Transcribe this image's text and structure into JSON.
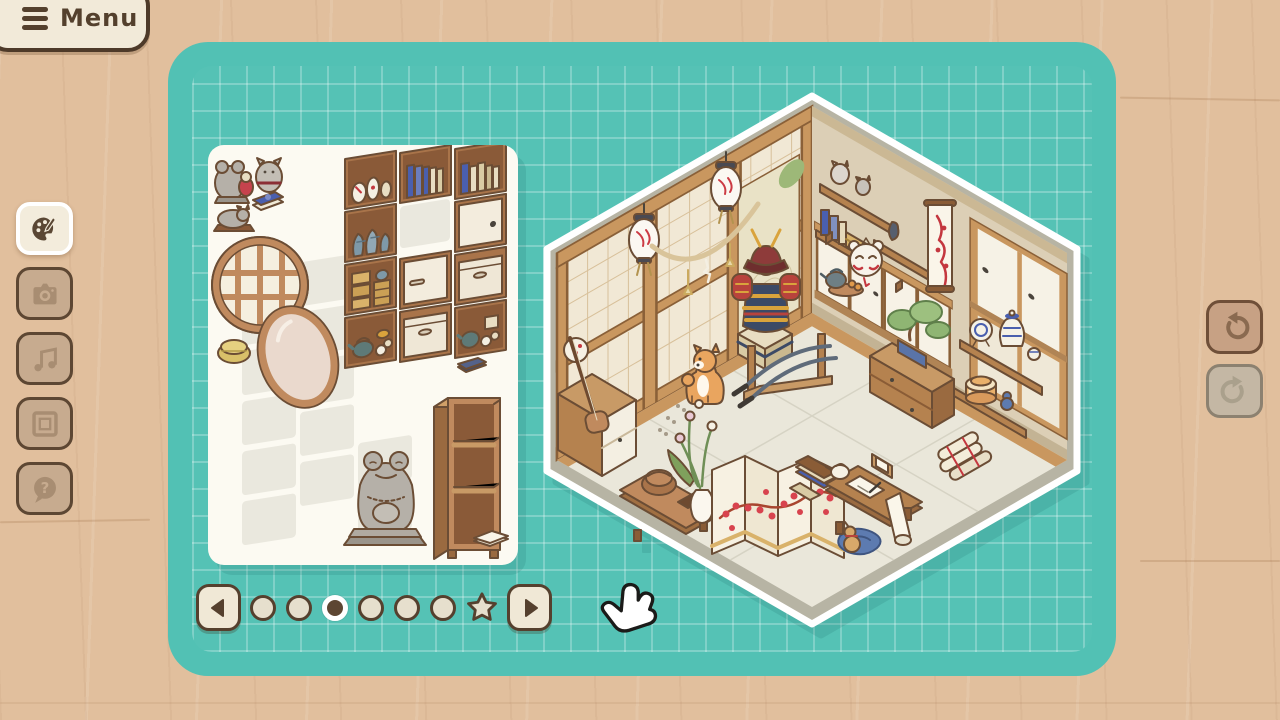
{
  "menu": {
    "label": "Menu",
    "icon": "hamburger-icon"
  },
  "sidebar": {
    "help_glyph": "?",
    "tools": [
      {
        "id": "decorate",
        "icon": "palette-icon",
        "active": true
      },
      {
        "id": "photo",
        "icon": "camera-icon",
        "active": false
      },
      {
        "id": "music",
        "icon": "music-note-icon",
        "active": false
      },
      {
        "id": "frame",
        "icon": "picture-frame-icon",
        "active": false
      },
      {
        "id": "help",
        "icon": "question-icon",
        "active": false
      }
    ]
  },
  "history": {
    "undo": {
      "icon": "rotate-ccw-icon",
      "enabled": true
    },
    "redo": {
      "icon": "rotate-cw-icon",
      "enabled": false
    }
  },
  "pagination": {
    "pages_total": 7,
    "active_index": 2,
    "pages": [
      "dot",
      "dot",
      "dot",
      "dot",
      "dot",
      "dot",
      "star"
    ],
    "prev_icon": "arrow-left-icon",
    "next_icon": "arrow-right-icon"
  },
  "tray": {
    "items": [
      "frog-statue-pair",
      "lucky-cat-statue",
      "blue-book",
      "sleeping-cat-statue",
      "round-lattice-window",
      "oval-mirror",
      "straw-basket",
      "shelf-sake-jars",
      "shelf-blue-vases",
      "shelf-wooden-crates",
      "shelf-teapot-set",
      "shelf-blue-books",
      "shelf-cabinet-door",
      "shelf-drawer",
      "shelf-cream-books",
      "shelf-door-knob",
      "shelf-drawer-2",
      "shelf-tea-jars",
      "small-dark-book",
      "stone-frog-statue",
      "empty-bookshelf",
      "wooden-tablet",
      "wooden-book",
      "open-book"
    ],
    "empty_slots": 11
  },
  "room": {
    "style": "japanese-tatami-room",
    "items": [
      "paper-lantern",
      "paper-lantern-2",
      "shimenawa-rope",
      "zen-garden-alcove",
      "wall-shelves-figurines",
      "hanging-scroll",
      "fox-mask",
      "teapot-tray",
      "samurai-armor",
      "katana-stand",
      "shiba-dog",
      "paw-prints",
      "folding-screen-blossoms",
      "low-table-basket",
      "flower-vase",
      "writing-desk",
      "paper-scroll",
      "book-stacks",
      "blue-cushion",
      "gourd",
      "scroll-pile",
      "tansu-chest-bonsai",
      "porcelain-shelves",
      "striped-box",
      "shamisen-cabinet",
      "hand-drum",
      "sliding-cabinets",
      "window-panels"
    ]
  },
  "cursor": {
    "type": "hand-pointer"
  },
  "colors": {
    "background": "#e1bf9d",
    "board": "#52c1b4",
    "grid_line": "#79d3c7",
    "panel": "#fcfaf2",
    "button_cream": "#f2ead9",
    "button_tan": "#c7ab8f",
    "border_dark": "#54402d",
    "wood": "#c08a5e",
    "accent_red": "#c4373f",
    "porcelain_blue": "#4a5fae",
    "rim_gray": "#b7b4a4",
    "tatami": "#eae7da"
  }
}
